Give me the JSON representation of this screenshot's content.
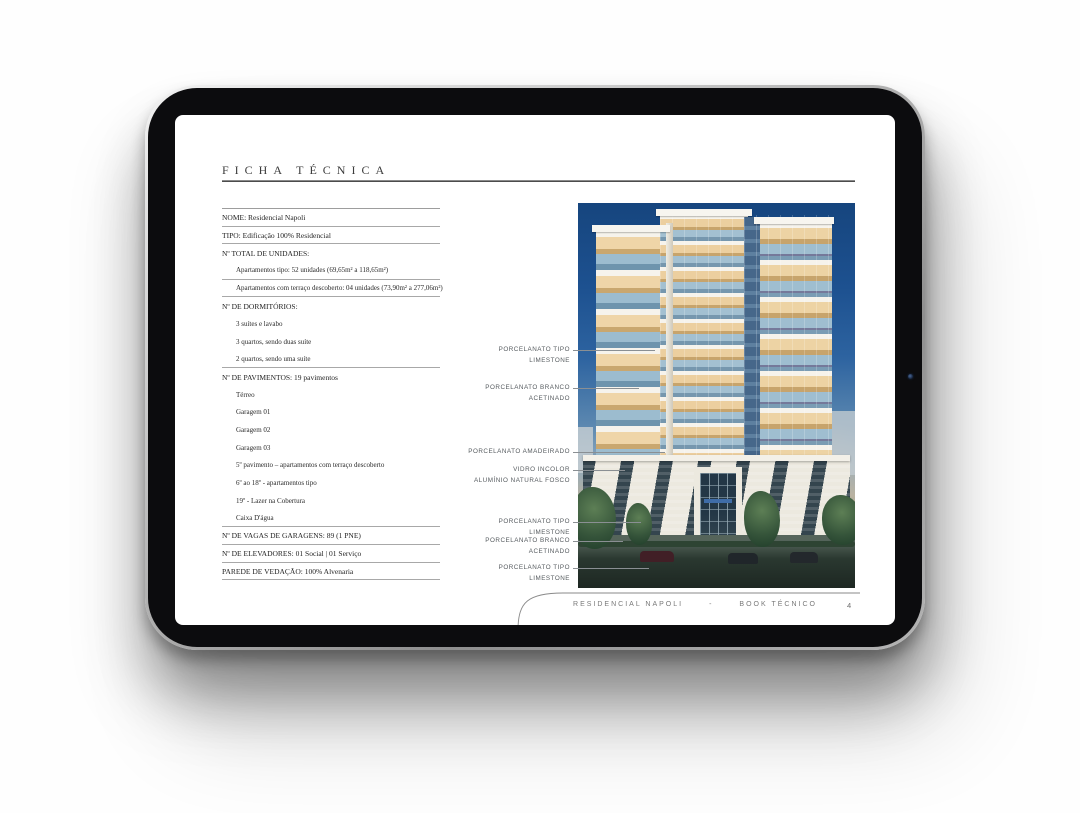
{
  "device": {
    "type": "tablet-mockup",
    "camera_icon": "front-camera-dot"
  },
  "page": {
    "title": "FICHA TÉCNICA",
    "page_number": "4",
    "footer": {
      "project": "RESIDENCIAL NAPOLI",
      "separator": "-",
      "doc": "BOOK TÉCNICO"
    }
  },
  "ficha": {
    "rows": [
      {
        "text": "NOME: Residencial Napoli",
        "level": 0,
        "rule": true
      },
      {
        "text": "TIPO: Edificação 100% Residencial",
        "level": 0,
        "rule": true
      },
      {
        "text": "Nº TOTAL DE UNIDADES:",
        "level": 0,
        "rule": false
      },
      {
        "text": "Apartamentos tipo: 52 unidades (69,65m² a 118,65m²)",
        "level": 1,
        "rule": true
      },
      {
        "text": "Apartamentos com terraço descoberto: 04 unidades (73,90m² a 277,06m²)",
        "level": 1,
        "rule": true
      },
      {
        "text": "Nº DE DORMITÓRIOS:",
        "level": 0,
        "rule": false
      },
      {
        "text": "3 suítes e lavabo",
        "level": 1,
        "rule": false
      },
      {
        "text": "3 quartos, sendo duas suíte",
        "level": 1,
        "rule": false
      },
      {
        "text": "2 quartos, sendo uma suíte",
        "level": 1,
        "rule": true
      },
      {
        "text": "Nº DE PAVIMENTOS: 19 pavimentos",
        "level": 0,
        "rule": false
      },
      {
        "text": "Térreo",
        "level": 1,
        "rule": false
      },
      {
        "text": "Garagem 01",
        "level": 1,
        "rule": false
      },
      {
        "text": "Garagem 02",
        "level": 1,
        "rule": false
      },
      {
        "text": "Garagem 03",
        "level": 1,
        "rule": false
      },
      {
        "text": "5º pavimento – apartamentos com terraço descoberto",
        "level": 1,
        "rule": false
      },
      {
        "text": "6º ao 18º - apartamentos tipo",
        "level": 1,
        "rule": false
      },
      {
        "text": "19º - Lazer na Cobertura",
        "level": 1,
        "rule": false
      },
      {
        "text": "Caixa D'água",
        "level": 1,
        "rule": true
      },
      {
        "text": "Nº DE VAGAS DE GARAGENS: 89 (1 PNE)",
        "level": 0,
        "rule": true
      },
      {
        "text": "Nº DE ELEVADORES: 01 Social | 01 Serviço",
        "level": 0,
        "rule": true
      },
      {
        "text": "PAREDE DE VEDAÇÃO: 100% Alvenaria",
        "level": 0,
        "rule": true
      }
    ]
  },
  "callouts": [
    {
      "lines": [
        "PORCELANATO TIPO",
        "LIMESTONE"
      ]
    },
    {
      "lines": [
        "PORCELANATO BRANCO",
        "ACETINADO"
      ]
    },
    {
      "lines": [
        "PORCELANATO AMADEIRADO"
      ]
    },
    {
      "lines": [
        "VIDRO INCOLOR",
        "ALUMÍNIO NATURAL FOSCO"
      ]
    },
    {
      "lines": [
        "PORCELANATO TIPO",
        "LIMESTONE"
      ]
    },
    {
      "lines": [
        "PORCELANATO BRANCO",
        "ACETINADO"
      ]
    },
    {
      "lines": [
        "PORCELANATO TIPO",
        "LIMESTONE"
      ]
    }
  ],
  "building_image": {
    "description": "Residencial Napoli residential tower rendering at dusk with lit balconies, garage podium, trees and street",
    "colors": {
      "sky_top": "#16457e",
      "sky_mid": "#5c88b0",
      "balcony_glow": "#efd5a8",
      "facade_white": "#f6f3ec",
      "glass": "#9cbccf"
    }
  }
}
